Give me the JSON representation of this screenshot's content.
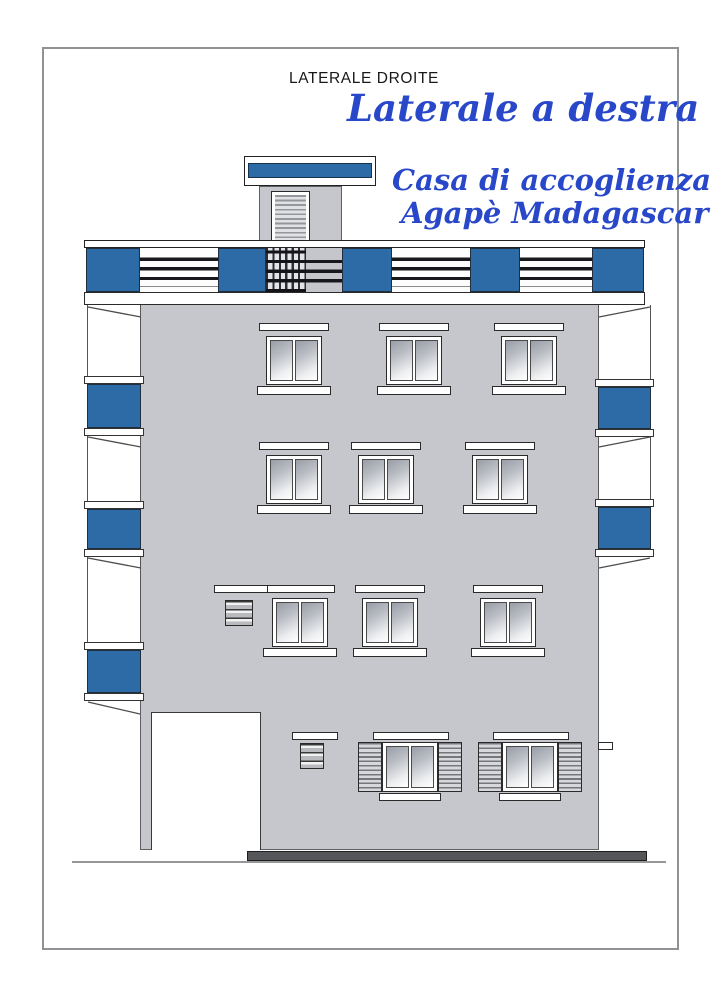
{
  "titles": {
    "subtitle_top": "LATERALE DROITE",
    "main_title": "Laterale a destra",
    "caption_line1": "Casa di accoglienza",
    "caption_line2": "Agapè Madagascar"
  },
  "colors": {
    "title_blue": "#2948c9",
    "panel_blue": "#2d6ba6",
    "facade_gray": "#c6c7cd",
    "base_gray": "#55565a"
  },
  "drawing": {
    "type": "building-side-elevation",
    "parapet_panels": [
      {
        "t": "blue",
        "w": 54
      },
      {
        "t": "louver",
        "w": 78
      },
      {
        "t": "blue",
        "w": 48
      },
      {
        "t": "hatch",
        "w": 40
      },
      {
        "t": "louvergray",
        "w": 36
      },
      {
        "t": "blue",
        "w": 50
      },
      {
        "t": "louver",
        "w": 78
      },
      {
        "t": "blue",
        "w": 50
      },
      {
        "t": "louver",
        "w": 72
      },
      {
        "t": "blue",
        "w": 52
      }
    ],
    "balcony_left": [
      {
        "t": "open",
        "h": 71
      },
      {
        "t": "slab",
        "h": 8
      },
      {
        "t": "blue",
        "h": 44
      },
      {
        "t": "slab",
        "h": 8
      },
      {
        "t": "open",
        "h": 65
      },
      {
        "t": "slab",
        "h": 8
      },
      {
        "t": "blue",
        "h": 40
      },
      {
        "t": "slab",
        "h": 8
      },
      {
        "t": "open",
        "h": 85
      },
      {
        "t": "slab",
        "h": 8
      },
      {
        "t": "blue",
        "h": 43
      },
      {
        "t": "slab",
        "h": 8
      }
    ],
    "balcony_right": [
      {
        "t": "open",
        "h": 74
      },
      {
        "t": "slab",
        "h": 8
      },
      {
        "t": "blue",
        "h": 42
      },
      {
        "t": "slab",
        "h": 8
      },
      {
        "t": "open",
        "h": 62
      },
      {
        "t": "slab",
        "h": 8
      },
      {
        "t": "blue",
        "h": 42
      },
      {
        "t": "slab",
        "h": 8
      }
    ],
    "upper_windows": [
      {
        "x": 266,
        "y": 336
      },
      {
        "x": 386,
        "y": 336
      },
      {
        "x": 501,
        "y": 336
      },
      {
        "x": 266,
        "y": 455
      },
      {
        "x": 358,
        "y": 455
      },
      {
        "x": 472,
        "y": 455
      },
      {
        "x": 272,
        "y": 598
      },
      {
        "x": 362,
        "y": 598
      },
      {
        "x": 480,
        "y": 598
      }
    ],
    "ground_windows": [
      {
        "x": 358,
        "y": 742
      },
      {
        "x": 478,
        "y": 742
      }
    ],
    "vents": [
      {
        "x": 225,
        "y": 600,
        "w": 28,
        "h": 26,
        "lx": 214,
        "ly": 585,
        "lw": 54
      },
      {
        "x": 300,
        "y": 743,
        "w": 24,
        "h": 26,
        "lx": 292,
        "ly": 732,
        "lw": 46
      }
    ]
  }
}
